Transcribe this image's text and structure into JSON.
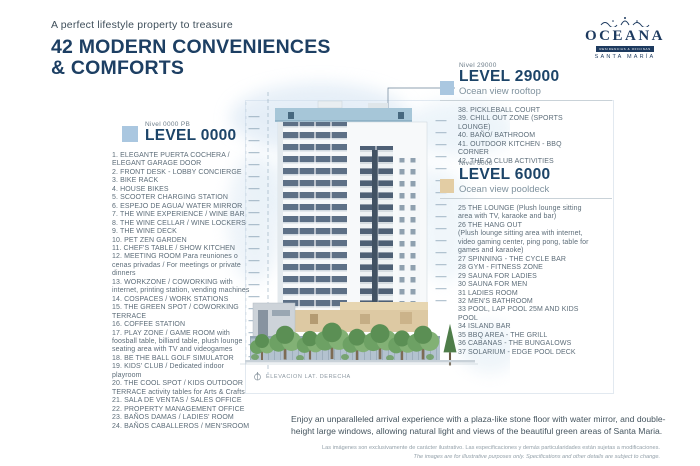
{
  "header": {
    "tagline": "A perfect lifestyle property to treasure",
    "title_line_1": "42 MODERN CONVENIENCES",
    "title_line_2": "& COMFORTS"
  },
  "logo": {
    "name": "OCEANA",
    "subtitle": "RESIDENCIAS & OFICINAS",
    "location": "SANTA MARÍA"
  },
  "theme": {
    "navy": "#1d3f63",
    "heading_blue": "#1c4468",
    "list_text": "#5d6d79",
    "accent_blue": "#aac7e0",
    "accent_tan": "#e3cda4"
  },
  "levels": [
    {
      "id": "level-0000",
      "nivel": "Nivel 0000 PB",
      "label": "LEVEL 0000",
      "sublabel": "",
      "square_color": "#aac7e0",
      "items": [
        "1. ELEGANTE PUERTA COCHERA / ELEGANT GARAGE DOOR",
        "2. FRONT DESK - LOBBY CONCIERGE",
        "3. BIKE RACK",
        "4. HOUSE BIKES",
        "5. SCOOTER CHARGING STATION",
        "6. ESPEJO DE AGUA/ WATER MIRROR",
        "7. THE WINE EXPERIENCE / WINE BAR",
        "8. THE WINE CELLAR / WINE LOCKERS",
        "9. THE WINE DECK",
        "10. PET ZEN GARDEN",
        "11. CHEF'S TABLE / SHOW KITCHEN",
        "12. MEETING ROOM Para reuniones o cenas privadas / For meetings or private dinners",
        "13. WORKZONE / COWORKING with internet, printing station, vending machines",
        "14. COSPACES / WORK STATIONS",
        "15. THE GREEN SPOT / COWORKING TERRACE",
        "16. COFFEE STATION",
        "17. PLAY ZONE / GAME ROOM with foosball table, billiard table, plush lounge seating area with TV and videogames",
        "18. BE THE BALL GOLF SIMULATOR",
        "19. KIDS' CLUB / Dedicated indoor playroom",
        "20. THE COOL SPOT / KIDS OUTDOOR TERRACE activity tables for Arts & Crafts",
        "21. SALA DE VENTAS / SALES OFFICE",
        "22. PROPERTY MANAGEMENT OFFICE",
        "23. BAÑOS DAMAS / LADIES' ROOM",
        "24. BAÑOS CABALLEROS / MEN'SROOM"
      ]
    },
    {
      "id": "level-29000",
      "nivel": "Nivel 29000",
      "label": "LEVEL 29000",
      "sublabel": "Ocean view rooftop",
      "square_color": "#aac7e0",
      "items": [
        "38. PICKLEBALL COURT",
        "39. CHILL OUT ZONE (SPORTS LOUNGE)",
        "40. BAÑO/ BATHROOM",
        "41. OUTDOOR KITCHEN - BBQ CORNER",
        "42. THE O CLUB ACTIVITIES"
      ]
    },
    {
      "id": "level-6000",
      "nivel": "Nivel 6000",
      "label": "LEVEL 6000",
      "sublabel": "Ocean view pooldeck",
      "square_color": "#e3cda4",
      "items": [
        "25 THE LOUNGE (Plush lounge sitting area with TV, karaoke and bar)",
        "26 THE HANG OUT\n(Plush lounge sitting area with internet, video gaming center, ping pong, table for games and karaoke)",
        "27 SPINNING - THE CYCLE BAR",
        "28 GYM - FITNESS ZONE",
        "29 SAUNA FOR LADIES",
        "30 SAUNA FOR MEN",
        "31 LADIES ROOM",
        "32 MEN'S BATHROOM",
        "33 POOL, LAP POOL 25M AND KIDS POOL",
        "34 ISLAND BAR",
        "35 BBQ AREA - THE GRILL",
        "36 CABANAS - THE BUNGALOWS",
        "37 SOLARIUM - EDGE POOL DECK"
      ]
    }
  ],
  "drawing": {
    "caption": "ELEVACION LAT. DERECHA"
  },
  "footer": {
    "description": "Enjoy an unparalleled arrival experience with a plaza-like stone floor with water mirror, and double-height large windows, allowing natural light and views of the beautiful green areas of Santa Maria.",
    "disclaimer_line_1": "Las imágenes son exclusivamente de carácter ilustrativo. Las especificaciones y demás particularidades están sujetas a modificaciones.",
    "disclaimer_line_2": "The images are for illustrative purposes only. Specifications and other details are subject to change."
  }
}
